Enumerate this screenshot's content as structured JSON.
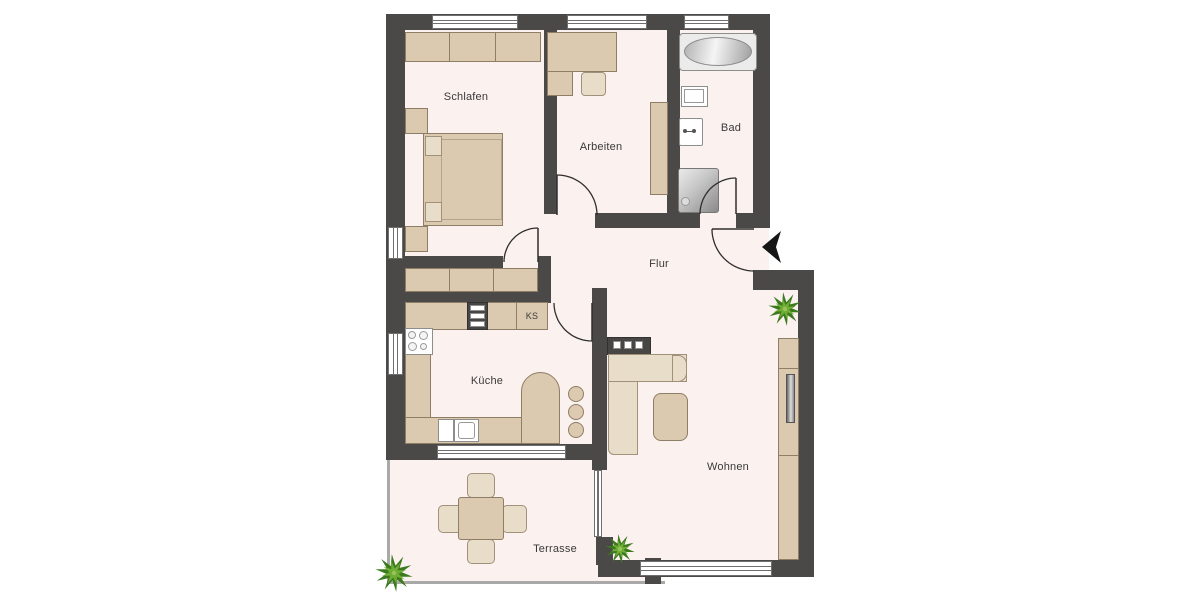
{
  "plan": {
    "type": "apartment-floorplan",
    "language": "de",
    "labels": {
      "schlafen": "Schlafen",
      "arbeiten": "Arbeiten",
      "bad": "Bad",
      "flur": "Flur",
      "kueche": "Küche",
      "wohnen": "Wohnen",
      "terrasse": "Terrasse",
      "fridge": "KS"
    },
    "colors": {
      "wall": "#4a4947",
      "floor": "#fbf1ef",
      "furniture": "#dbc9b0",
      "furniture_border": "#8f7e66",
      "furniture_light": "#e8ddc9",
      "appliance_dark": "#474645",
      "window_line": "#6f6f6f",
      "label_text": "#3a3a3a",
      "plant_dark": "#3c7a1e",
      "plant_light": "#6fae35",
      "door_arc": "#2f2f2f",
      "terrace_edge": "#a9a9a9",
      "entry_arrow": "#161616"
    },
    "rooms": [
      {
        "id": "schlafen",
        "label": "Schlafen",
        "furniture": [
          "wardrobe",
          "double-bed",
          "nightstand",
          "nightstand"
        ]
      },
      {
        "id": "arbeiten",
        "label": "Arbeiten",
        "furniture": [
          "corner-desk",
          "office-chair",
          "bookshelf"
        ]
      },
      {
        "id": "bad",
        "label": "Bad",
        "furniture": [
          "bathtub",
          "washbasin",
          "toilet",
          "shower"
        ]
      },
      {
        "id": "flur",
        "label": "Flur",
        "furniture": [
          "sideboard",
          "entry-door"
        ]
      },
      {
        "id": "kueche",
        "label": "Küche",
        "furniture": [
          "counter",
          "oven-tower",
          "fridge-KS",
          "stove",
          "sink",
          "bar-counter",
          "bar-stools"
        ]
      },
      {
        "id": "wohnen",
        "label": "Wohnen",
        "furniture": [
          "corner-sofa",
          "coffee-table",
          "drawer-unit",
          "tv-lowboard",
          "tv",
          "plants"
        ]
      },
      {
        "id": "terrasse",
        "label": "Terrasse",
        "furniture": [
          "table",
          "chairs",
          "plant"
        ]
      }
    ]
  }
}
